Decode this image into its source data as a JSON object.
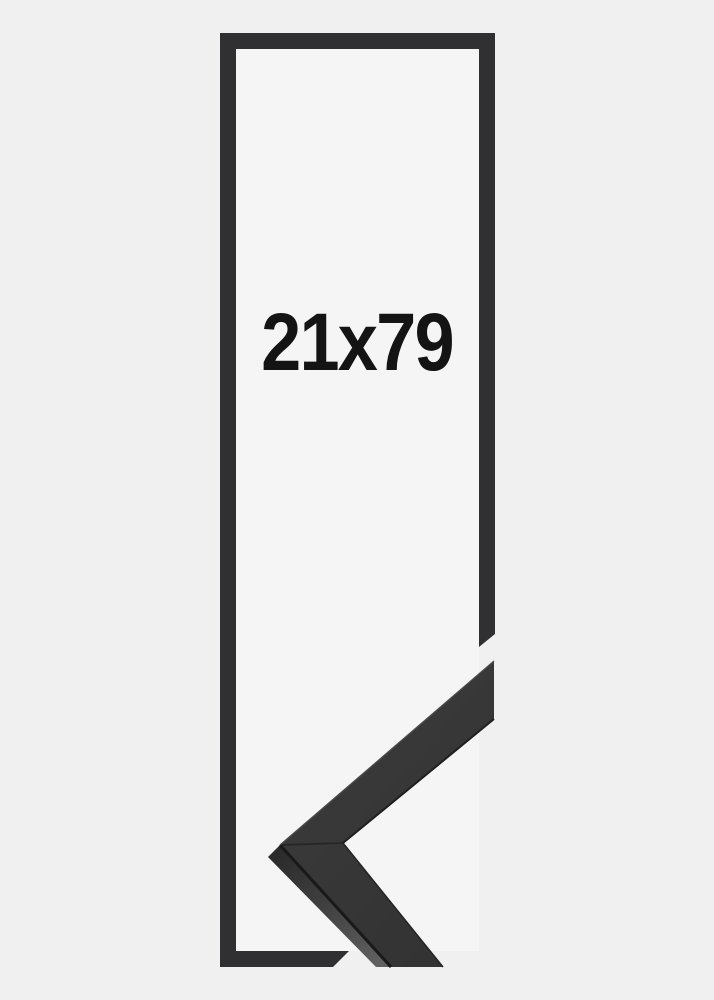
{
  "frame": {
    "size_label": "21x79"
  },
  "colors": {
    "background": "#f0f0f0",
    "frame_interior": "#f5f5f5",
    "frame_outline": "#303032",
    "moulding_top_face": "#363636",
    "moulding_side_dark": "#2c2c2c",
    "moulding_side_light": "#606060",
    "moulding_edge_dark": "#191919",
    "moulding_edge_highlight": "#4d4d4d",
    "miter_seam": "#262626",
    "label_text": "#141414"
  }
}
